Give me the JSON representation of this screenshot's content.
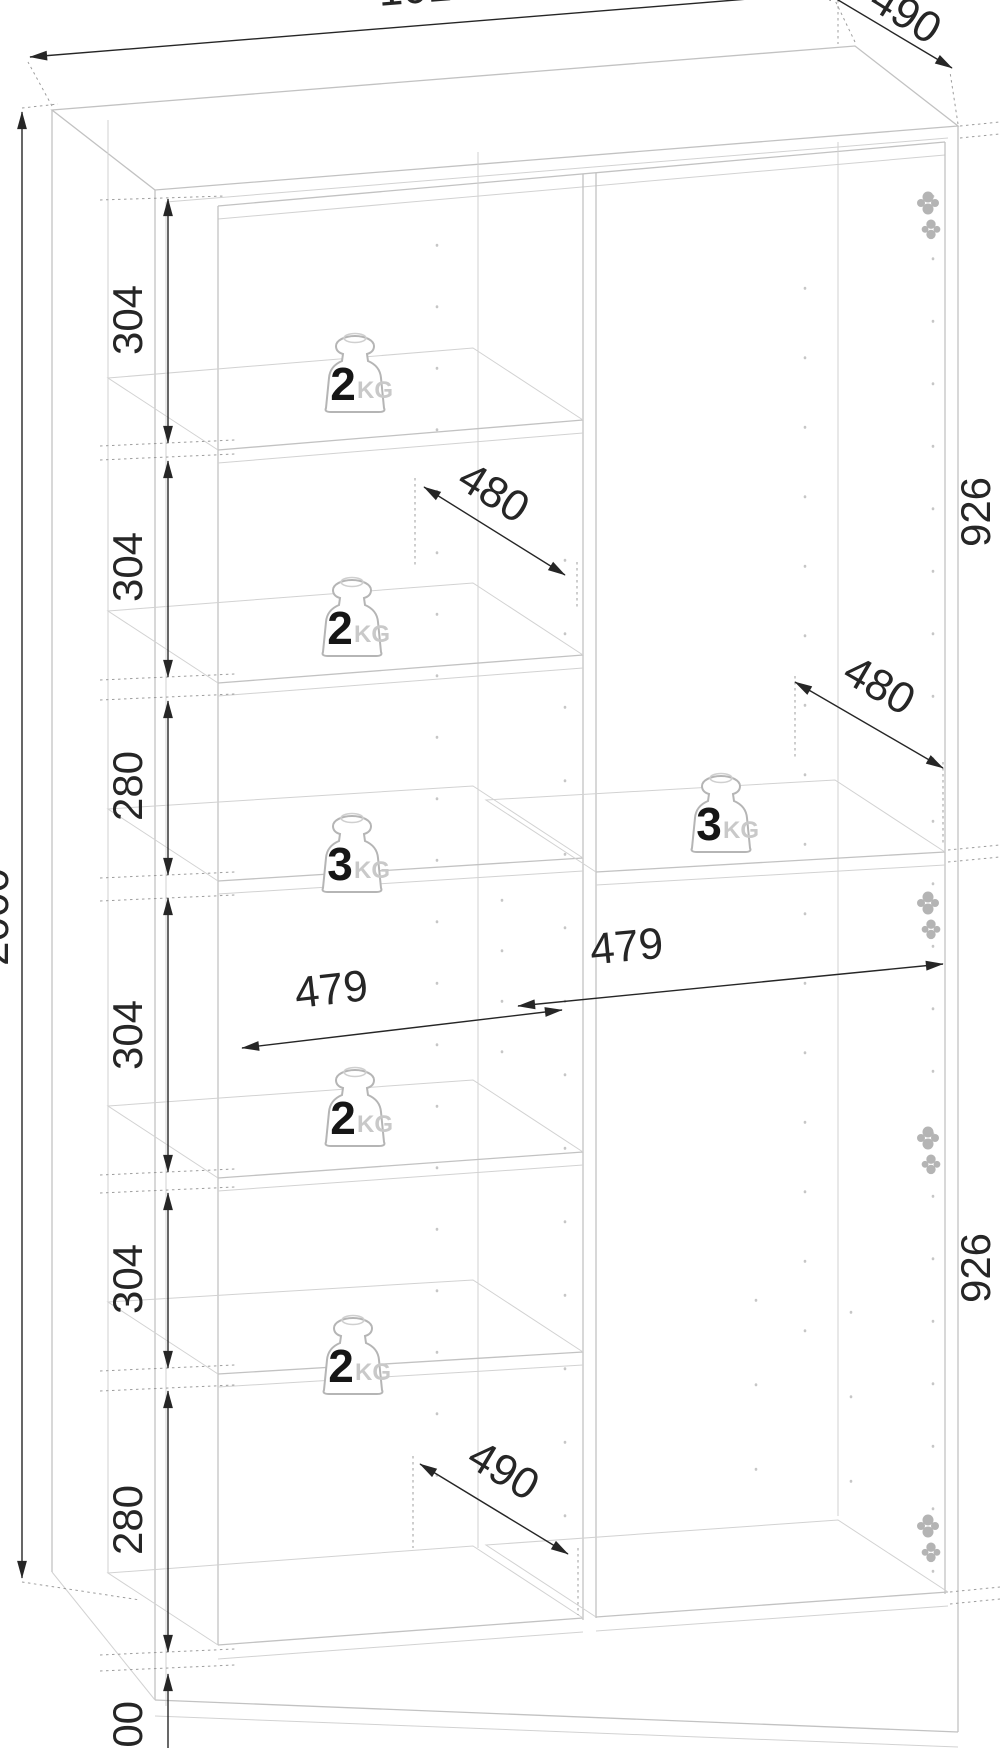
{
  "drawing": {
    "kind": "wardrobe-carcass-dimension-diagram"
  },
  "dims": {
    "width_top": "1010",
    "depth_top": "490",
    "height_total": "2000",
    "left_chain": [
      "304",
      "304",
      "280",
      "304",
      "304",
      "280",
      "100"
    ],
    "inner_width_left": "479",
    "inner_width_right": "479",
    "shelf_depth_upper": "480",
    "shelf_depth_right": "480",
    "shelf_depth_bottom": "490",
    "side_height_upper": "926",
    "side_height_lower": "926"
  },
  "weights": [
    {
      "value": "2",
      "unit": "KG"
    },
    {
      "value": "2",
      "unit": "KG"
    },
    {
      "value": "3",
      "unit": "KG"
    },
    {
      "value": "2",
      "unit": "KG"
    },
    {
      "value": "2",
      "unit": "KG"
    },
    {
      "value": "3",
      "unit": "KG"
    }
  ],
  "colors": {
    "background": "#ffffff",
    "wireframe": "#c2c2c2",
    "dimension": "#262626",
    "extension": "#9d9d9d",
    "hardware": "#b4b4b4",
    "kg_label": "#c9c9c9"
  }
}
